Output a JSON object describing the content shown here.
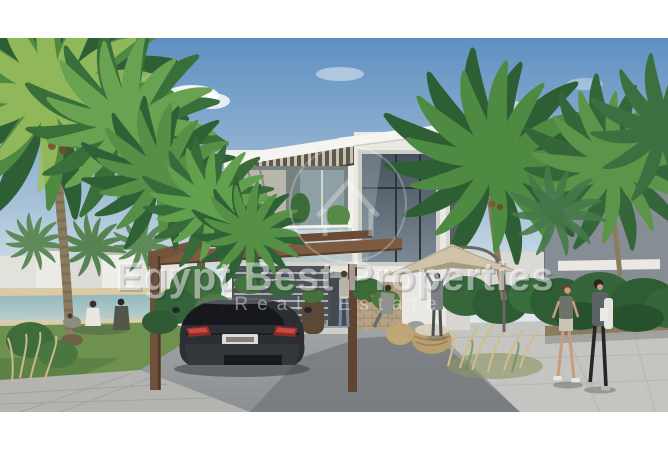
{
  "meta": {
    "type": "real-estate-architectural-rendering",
    "description": "Rendering of a modern two-storey white villa with wooden carport pergola, black sports car, palm trees, lagoon shoreline and people, framed by white borders top and bottom"
  },
  "watermark": {
    "title": "Egypt Best Properties",
    "subtitle": "Real Estate",
    "logo": "house-in-circle-icon",
    "color": "#ffffff"
  },
  "scene": {
    "subject": "modern white villa with glass balcony and slatted pergola",
    "foreground": "black coupe parked under wooden carport pergola",
    "left": "lawn with seated people, lagoon, beach and distant white buildings",
    "right": "two women walking on paved path beside green hedge and grey neighbouring wall",
    "patio": "beige cantilever umbrella with wicker seats and standing figures",
    "sky": "clear blue sky with small white clouds"
  },
  "palette": {
    "sky_top": "#5f90c1",
    "sky_horizon": "#dde6ea",
    "water": "#9fc0c4",
    "foliage": "#3f7a3f",
    "villa_wall": "#f0efeb",
    "wood": "#7b5a40",
    "driveway": "#95989b",
    "pavers": "#c6c6c2",
    "car": "#2b2f33",
    "umbrella": "#cfc3aa"
  }
}
